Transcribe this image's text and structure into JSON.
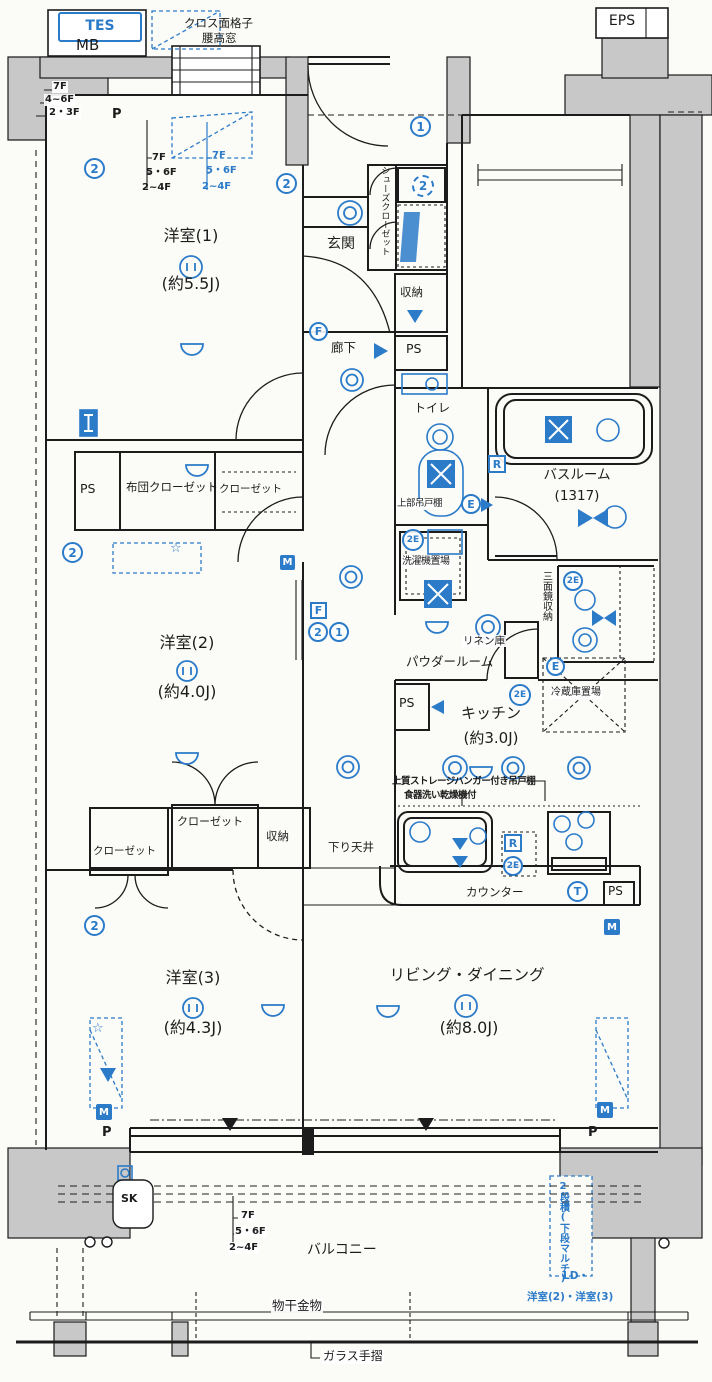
{
  "colors": {
    "accent": "#2b7bc9",
    "wall_gray": "#c8c8c8",
    "ink": "#1c1c1c"
  },
  "rooms": {
    "y1": {
      "name": "洋室(1)",
      "size": "(約5.5J)"
    },
    "y2": {
      "name": "洋室(2)",
      "size": "(約4.0J)"
    },
    "y3": {
      "name": "洋室(3)",
      "size": "(約4.3J)"
    },
    "ld": {
      "name": "リビング・ダイニング",
      "size": "(約8.0J)"
    },
    "kitchen": {
      "name": "キッチン",
      "size": "(約3.0J)"
    },
    "genkan": "玄関",
    "rouka": "廊下",
    "toilet": "トイレ",
    "bath": {
      "name": "バスルーム",
      "size": "(1317)"
    },
    "powder": "パウダールーム",
    "balcony": "バルコニー"
  },
  "storage": {
    "shoes": "シューズクローゼット",
    "sto1": "収納",
    "sto2": "収納",
    "futon": "布団クローゼット",
    "closet1": "クローゼット",
    "closet2": "クローゼット",
    "closet3": "クローゼット",
    "linen": "リネン庫",
    "mirror": "三面鏡収納",
    "fridge": "冷蔵庫置場",
    "washer": "洗濯機置場",
    "upper": "上部吊戸棚",
    "counter": "カウンター",
    "dropceil": "下り天井"
  },
  "notes": {
    "grille1": "クロス面格子",
    "grille2": "腰高窓",
    "kn1": "上質ストレージハンガー付き吊戸棚",
    "kn2": "食器洗い乾燥機付",
    "ac": "2段積(下段マルチ)",
    "acl": "LD・",
    "acr": "洋室(2)・洋室(3)",
    "mono": "物干金物",
    "glass": "ガラス手摺"
  },
  "floors": {
    "f7": "7F",
    "f46": "4~6F",
    "f23": "2・3F",
    "f56": "5・6F",
    "f24": "2~4F"
  },
  "labels": {
    "mb": "MB",
    "tes": "TES",
    "eps": "EPS",
    "sk": "SK",
    "ps": "PS",
    "p": "P"
  },
  "symbols": {
    "f": "F",
    "m": "M",
    "r": "R",
    "e": "E",
    "e2": "2E",
    "t": "T",
    "one": "1",
    "two": "2",
    "star": "☆"
  }
}
